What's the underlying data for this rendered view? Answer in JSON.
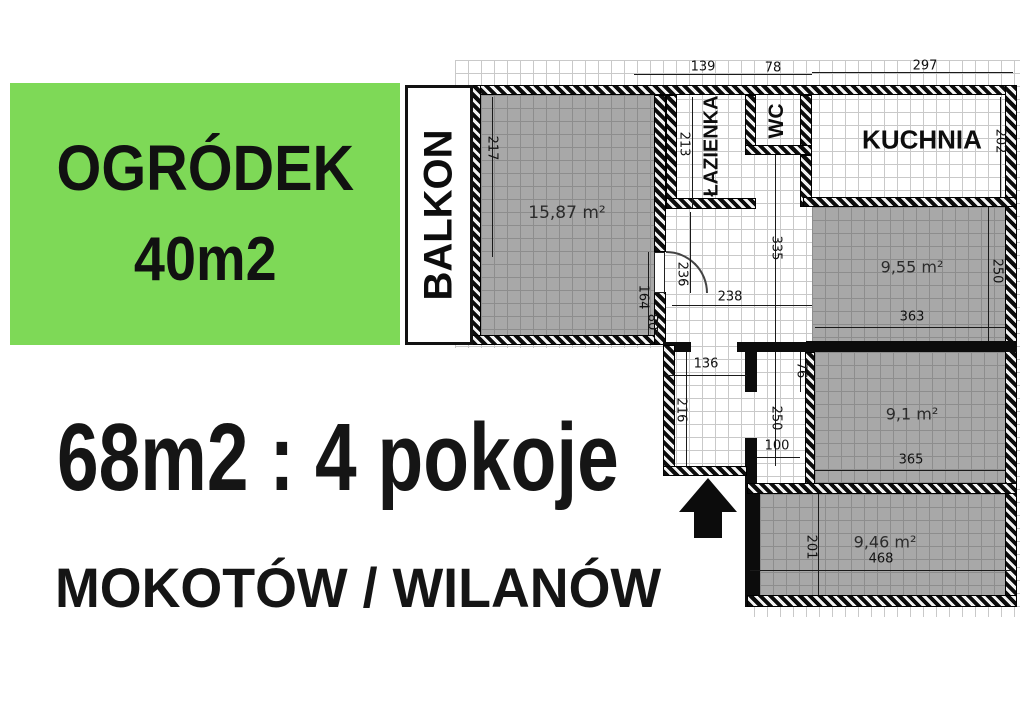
{
  "colors": {
    "garden_green": "#7ED957",
    "wall_black": "#0c0c0c",
    "room_gray": "#a8a8a8"
  },
  "garden": {
    "title": "OGRÓDEK",
    "size": "40m2"
  },
  "listing": {
    "summary": "68m2 : 4 pokoje",
    "location": "MOKOTÓW / WILANÓW"
  },
  "rooms": {
    "balkon": "BALKON",
    "lazienka": "ŁAZIENKA",
    "wc": "WC",
    "kuchnia": "KUCHNIA",
    "salon_area": "15,87 m²",
    "room_a_area": "9,55 m²",
    "room_b_area": "9,1 m²",
    "room_c_area": "9,46 m²"
  },
  "dims": {
    "top_bath_width": "139",
    "top_wc_width": "78",
    "top_kitchen_width": "297",
    "salon_height": "217",
    "hall_height": "213",
    "kitchen_height": "202",
    "door_width": "236",
    "hall_width": "238",
    "hall_length": "335",
    "salon_nook_a": "164",
    "salon_nook_b": "80",
    "room_a_width": "363",
    "room_a_height": "250",
    "corridor_width": "136",
    "nook_width": "76",
    "corridor_height": "216",
    "nook_height": "250",
    "nook_depth": "100",
    "room_b_width": "365",
    "room_c_height": "201",
    "room_c_width": "468"
  }
}
